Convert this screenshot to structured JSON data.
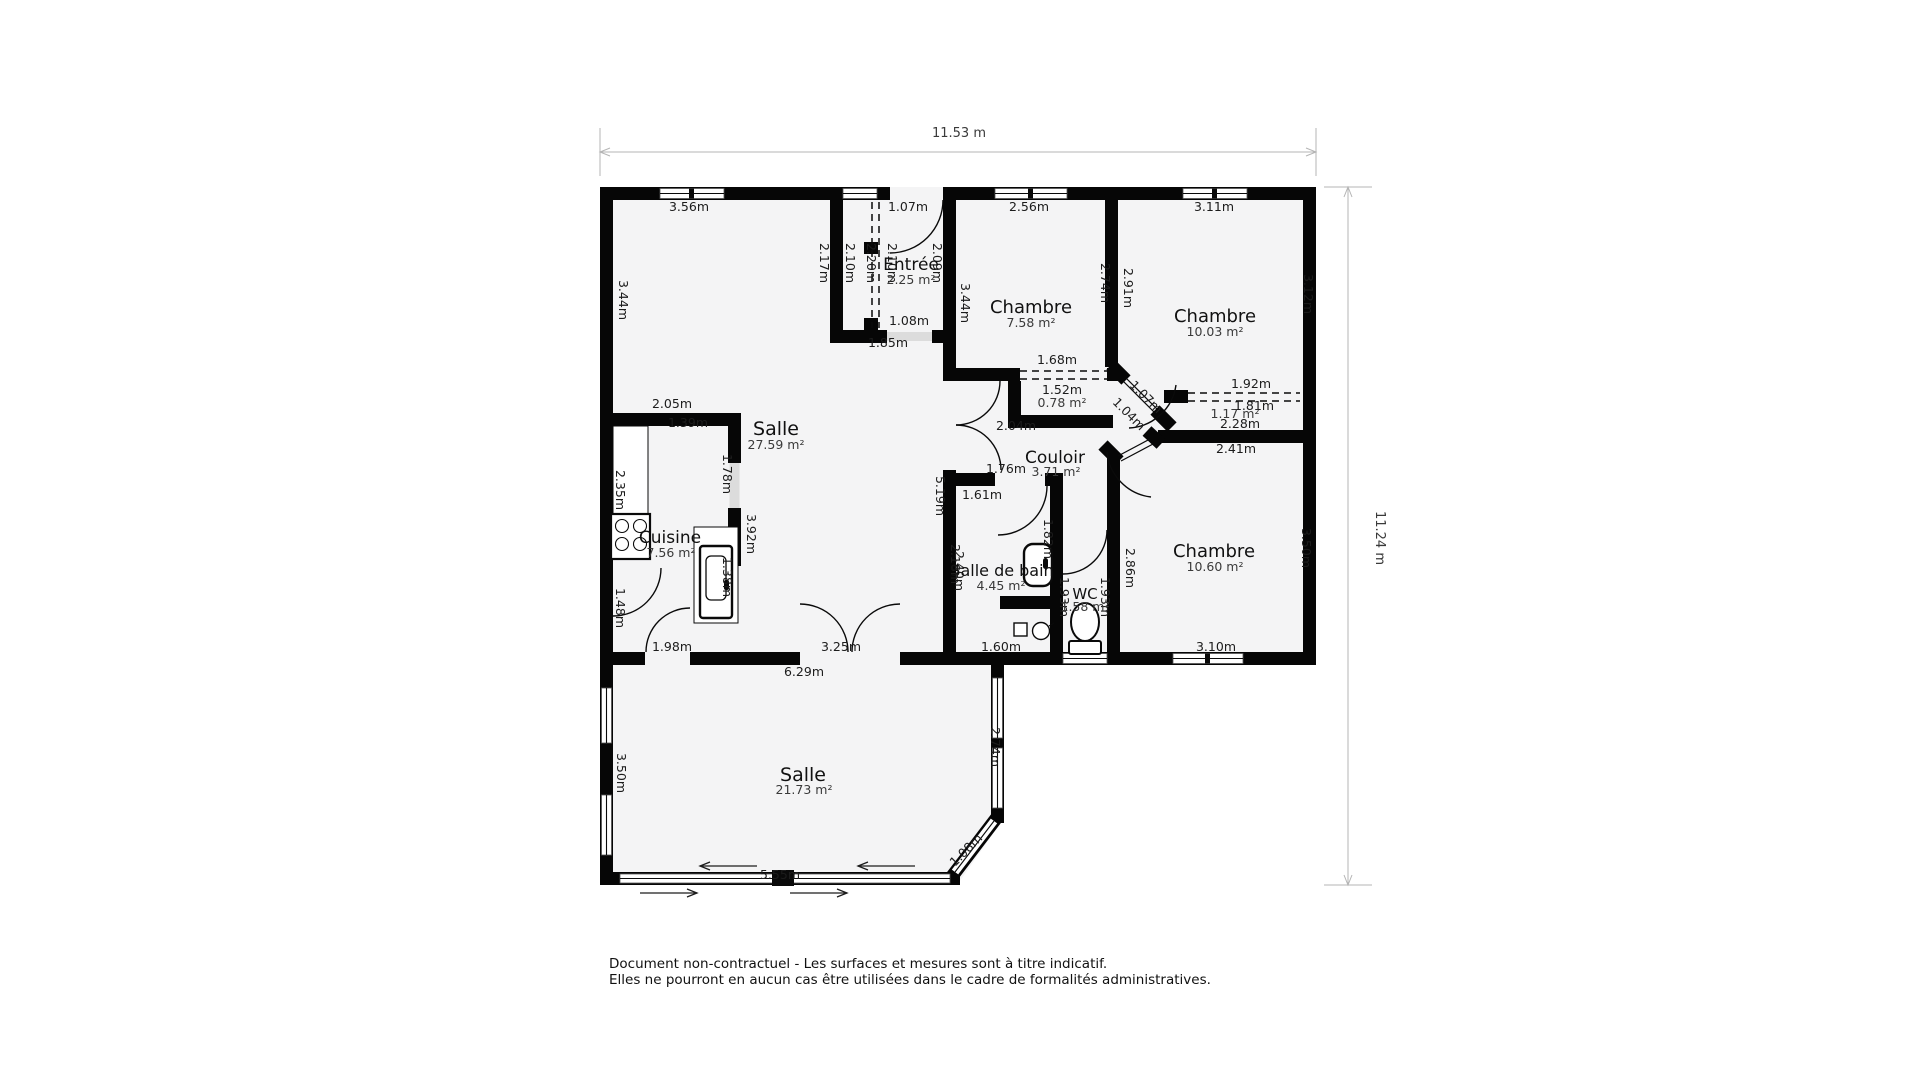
{
  "meta": {
    "top_dimension": "11.53 m",
    "right_dimension": "11.24 m"
  },
  "disclaimer": {
    "line1": "Document non-contractuel - Les surfaces et mesures sont à titre indicatif.",
    "line2": "Elles ne pourront en aucun cas être utilisées dans le cadre de formalités administratives."
  },
  "rooms": {
    "entree": {
      "name": "Entrée",
      "area": "2.25 m²"
    },
    "chambre1": {
      "name": "Chambre",
      "area": "7.58 m²"
    },
    "chambre2": {
      "name": "Chambre",
      "area": "10.03 m²"
    },
    "salle": {
      "name": "Salle",
      "area": "27.59 m²"
    },
    "couloir": {
      "name": "Couloir",
      "area": "3.71 m²"
    },
    "cuisine": {
      "name": "Cuisine",
      "area": "7.56 m²"
    },
    "salle_de_bain": {
      "name": "Salle de bain",
      "area": "4.45 m²"
    },
    "wc": {
      "name": "WC",
      "area": "1.58 m²"
    },
    "chambre3": {
      "name": "Chambre",
      "area": "10.60 m²"
    },
    "salle2": {
      "name": "Salle",
      "area": "21.73 m²"
    },
    "placard_couloir": {
      "area": "0.78 m²"
    },
    "placard_chambre2": {
      "area": "1.17 m²"
    }
  },
  "labels": {
    "top_356": "3.56m",
    "top_107": "1.07m",
    "top_256": "2.56m",
    "top_311": "3.11m",
    "ent_217": "2.17m",
    "ent_210a": "2.10m",
    "ent_220": "2.20m",
    "ent_210b": "2.10m",
    "ent_209": "2.09m",
    "ent_108": "1.08m",
    "ent_185": "1.85m",
    "salle_344": "3.44m",
    "ch1_344": "3.44m",
    "ch1_274": "2.74m",
    "ch1_168": "1.68m",
    "plc1_152": "1.52m",
    "wall_291": "2.91m",
    "ch2_312": "3.12m",
    "ch2_192": "1.92m",
    "plc2_181": "1.81m",
    "plc2_228": "2.28m",
    "ch3_241": "2.41m",
    "diag_107": "1.07m",
    "diag_104": "1.04m",
    "coul_204": "2.04m",
    "coul_176": "1.76m",
    "coul_161": "1.61m",
    "salle_205": "2.05m",
    "salle_139": "1.39m",
    "salle_178": "1.78m",
    "salle_392": "3.92m",
    "salle_519": "5.19m",
    "cui_235": "2.35m",
    "cui_148": "1.48m",
    "cui_138": "1.38m",
    "cui_198": "1.98m",
    "cui_325": "3.25m",
    "bot_629": "6.29m",
    "sdb_218": "2.18m",
    "sdb_240": "2.40m",
    "sdb_182": "1.82m",
    "sdb_160": "1.60m",
    "wc_193a": "1.93m",
    "wc_193b": "1.93m",
    "ch3_286": "2.86m",
    "ch3_350": "3.50m",
    "ch3_310": "3.10m",
    "s2_350": "3.50m",
    "s2_274": "2.74m",
    "s2_108": "1.08m",
    "s2_555": "5.55m"
  }
}
